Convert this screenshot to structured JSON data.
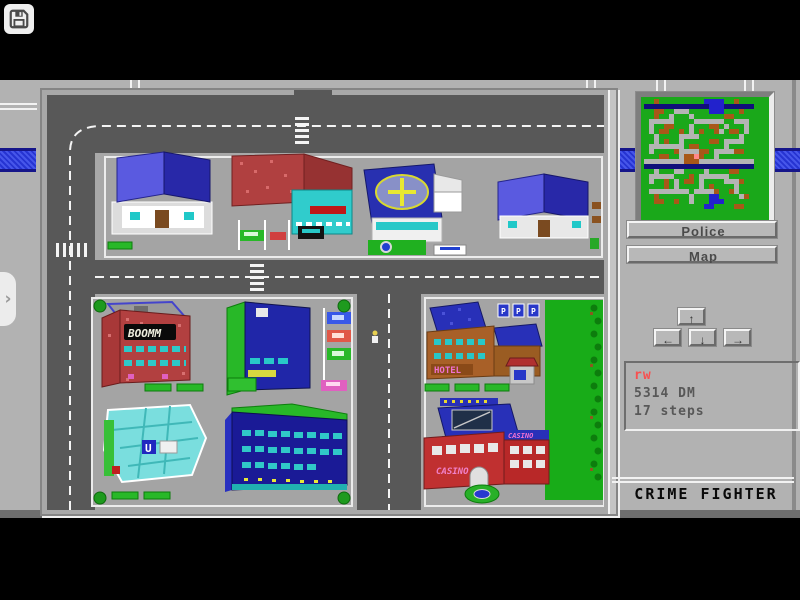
{
  "header": {
    "save_button_icon": "floppy-disk-icon",
    "drawer_chevron": "›"
  },
  "game": {
    "title": "CRIME FIGHTER",
    "panel": {
      "police_button": "Police",
      "map_button": "Map",
      "nav": {
        "up": "↑",
        "down": "↓",
        "left": "←",
        "right": "→"
      },
      "status": {
        "player_initials": "rw",
        "money": "5314 DM",
        "steps": "17 steps"
      }
    },
    "city": {
      "signs": {
        "cinema": "BOOMM",
        "hotel": "HOTEL",
        "casino_roof": "CASINO",
        "casino_annex": "CASINO",
        "casino_wall": "CASINO",
        "parking_letter": "P",
        "supermarket_letter": "U"
      }
    },
    "minimap": {
      "palette": {
        "g": "#1aa81a",
        "r": "#b4b4b4",
        "b": "#a85818",
        "u": "#2222cc",
        "n": "#10107a",
        "p": "#ff8888"
      },
      "rows": [
        "ggbggggggggguuuuggbggg",
        "nnnnnnnnnnnnnuuunnnnnn",
        "ggbbggrrrgggguuugggbgg",
        "ggbggrgggrggggggbbgggg",
        "grrrrrggggrrrrrrggrrrg",
        "grggbbgggrgggbbgrgggrg",
        "grgbbggbgrgbggbrgbbgrg",
        "ggrggggrrrrggggggggrgg",
        "ggrgbggrgggggbbgrrrrgg",
        "grrrrrrrgbbgggggrggggg",
        "grggggbrrrrbbgrrrrbbgg",
        "gggbbggrbbpbggrggggggg",
        "rrrrrrrrbbbrrrrrrrrrrr",
        "nnnnnnnnnnnnnnnnnnnnnn",
        "ggrgggrrggggrggggbbggg",
        "grrrrrgggbgrrrrrrggggg",
        "grggbgrgbbgrggggrrrbgg",
        "ggggbgrggggrgbggggrggg",
        "grrrrrrrrgrrrrbggbrggg",
        "ggbggggggrggguuggggrbg",
        "ggbbggbggrggguuugggggg",
        "gggggggggggguuggggbbgg"
      ]
    },
    "colors": {
      "band_blue": "#2634d2",
      "status_red": "#f85050",
      "status_gray": "#585858",
      "road_gray": "#585858",
      "sidewalk_gray": "#a8a8a8",
      "park_green": "#18ac18"
    }
  }
}
